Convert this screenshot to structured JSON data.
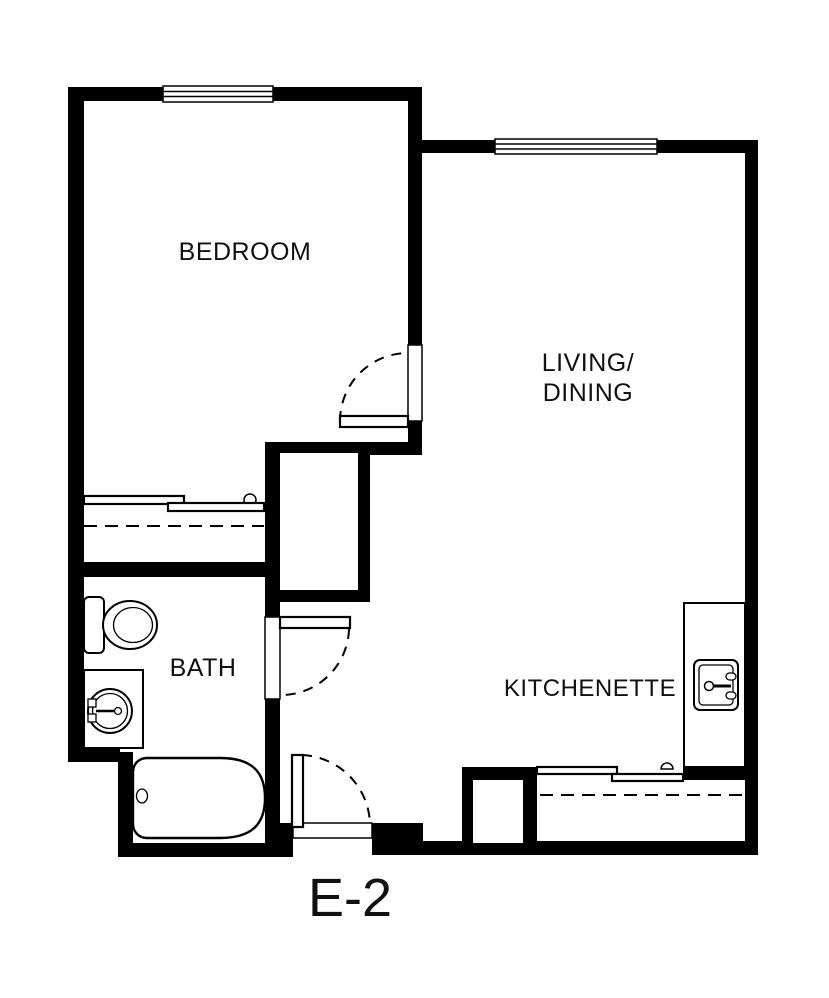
{
  "labels": {
    "bedroom": "BEDROOM",
    "living_line1": "LIVING/",
    "living_line2": "DINING",
    "bath": "BATH",
    "kitchenette": "KITCHENETTE",
    "unit": "E-2"
  },
  "colors": {
    "walls": "#000000",
    "background": "#ffffff",
    "text": "#111111"
  }
}
